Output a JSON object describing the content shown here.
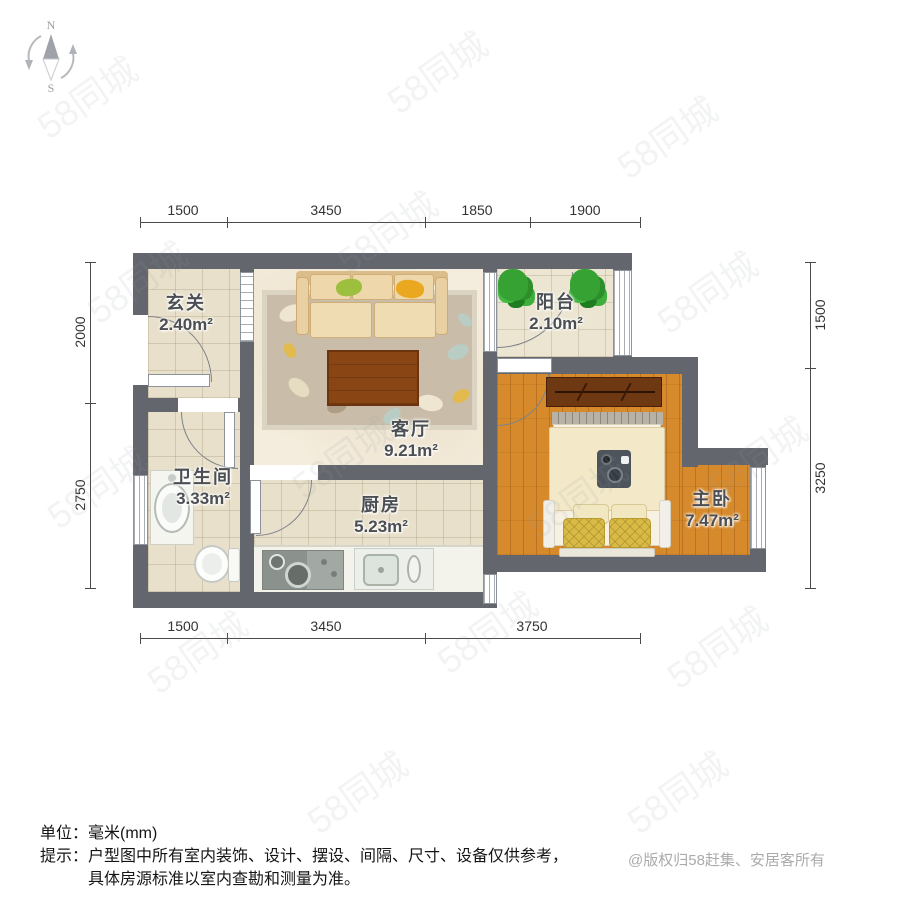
{
  "compass": {
    "north": "N",
    "south": "S"
  },
  "dimensions_mm": {
    "top": [
      "1500",
      "3450",
      "1850",
      "1900"
    ],
    "bottom": [
      "1500",
      "3450",
      "3750"
    ],
    "left": [
      "2000",
      "2750"
    ],
    "right": [
      "1500",
      "3250"
    ]
  },
  "rooms": {
    "entry": {
      "name": "玄关",
      "area": "2.40m²"
    },
    "living": {
      "name": "客厅",
      "area": "9.21m²"
    },
    "balcony": {
      "name": "阳台",
      "area": "2.10m²"
    },
    "bathroom": {
      "name": "卫生间",
      "area": "3.33m²"
    },
    "kitchen": {
      "name": "厨房",
      "area": "5.23m²"
    },
    "bedroom": {
      "name": "主卧",
      "area": "7.47m²"
    }
  },
  "watermark": {
    "text": "58同城"
  },
  "footer": {
    "unit": "单位：毫米(mm)",
    "tip_line1": "提示：户型图中所有室内装饰、设计、摆设、间隔、尺寸、设备仅供参考，",
    "tip_line2": "具体房源标准以室内查勘和测量为准。",
    "copyright": "@版权归58赶集、安居客所有"
  },
  "colors": {
    "wall": "#63666d",
    "tile_floor": "#e8e0ca",
    "living_floor": "#f4ecdc",
    "wood_floor": "#d78a2c",
    "rug": "#c9bda9",
    "coffee_table": "#8a4515",
    "sofa": "#eccfa0",
    "plant_green": "#36a233",
    "wardrobe": "#6e3812",
    "dimension_text": "#333333",
    "copyright_text": "#ababab"
  }
}
